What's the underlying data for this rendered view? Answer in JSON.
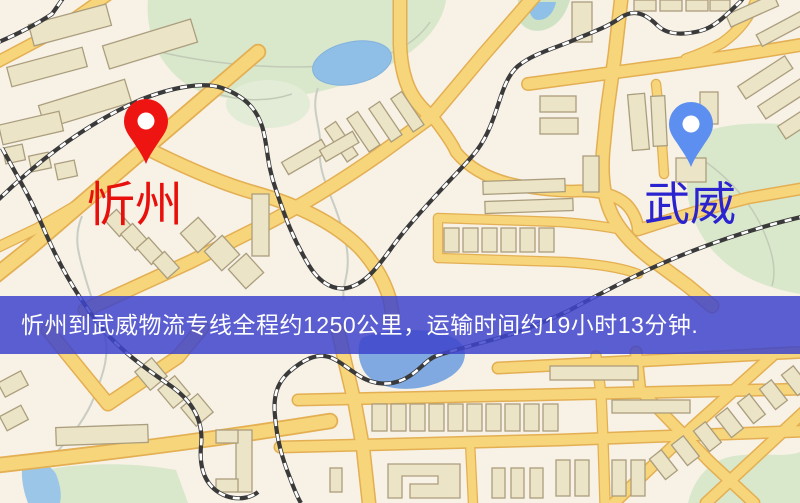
{
  "pins": {
    "origin": {
      "label": "忻州",
      "label_color": "#e8100c",
      "pin_color": "#ee1411"
    },
    "destination": {
      "label": "武威",
      "label_color": "#2a23cf",
      "pin_color": "#5d8ff0"
    }
  },
  "banner": {
    "text": "忻州到武威物流专线全程约1250公里，运输时间约19小时13分钟.",
    "background_color": "#3e44cb",
    "background_opacity": 0.85,
    "text_color": "#ffffff"
  },
  "map_palette": {
    "background": "#f7f1e6",
    "road_fill": "#f6d57b",
    "road_casing": "#e4af52",
    "building_fill": "#ece4c6",
    "building_stroke": "#ab9e7e",
    "greenery": "#d9e7ca",
    "water": "#8fbfe7",
    "railway_dark": "#3a3a3a",
    "railway_dash": "#ffffff"
  }
}
